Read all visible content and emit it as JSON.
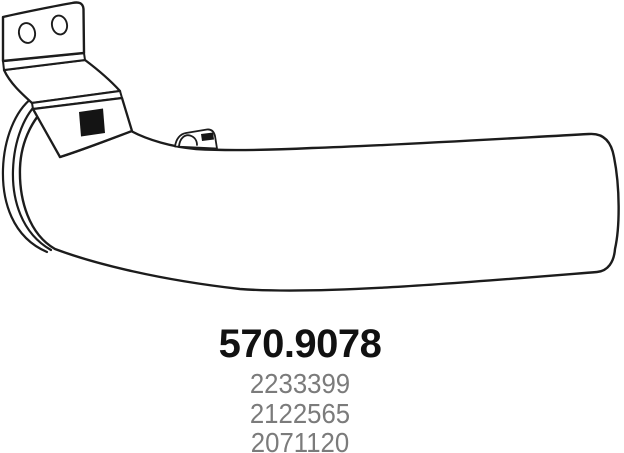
{
  "part": {
    "main_number": "570.9078",
    "oe_numbers": [
      "2233399",
      "2122565",
      "2071120"
    ]
  },
  "drawing": {
    "subject": "exhaust-pipe-with-mounting-bracket",
    "line_color": "#1c1c1c",
    "body_fill": "#ffffff",
    "accent_black": "#141414"
  },
  "text_colors": {
    "main_number": "#111111",
    "oe_numbers": "#7b7b7b"
  }
}
